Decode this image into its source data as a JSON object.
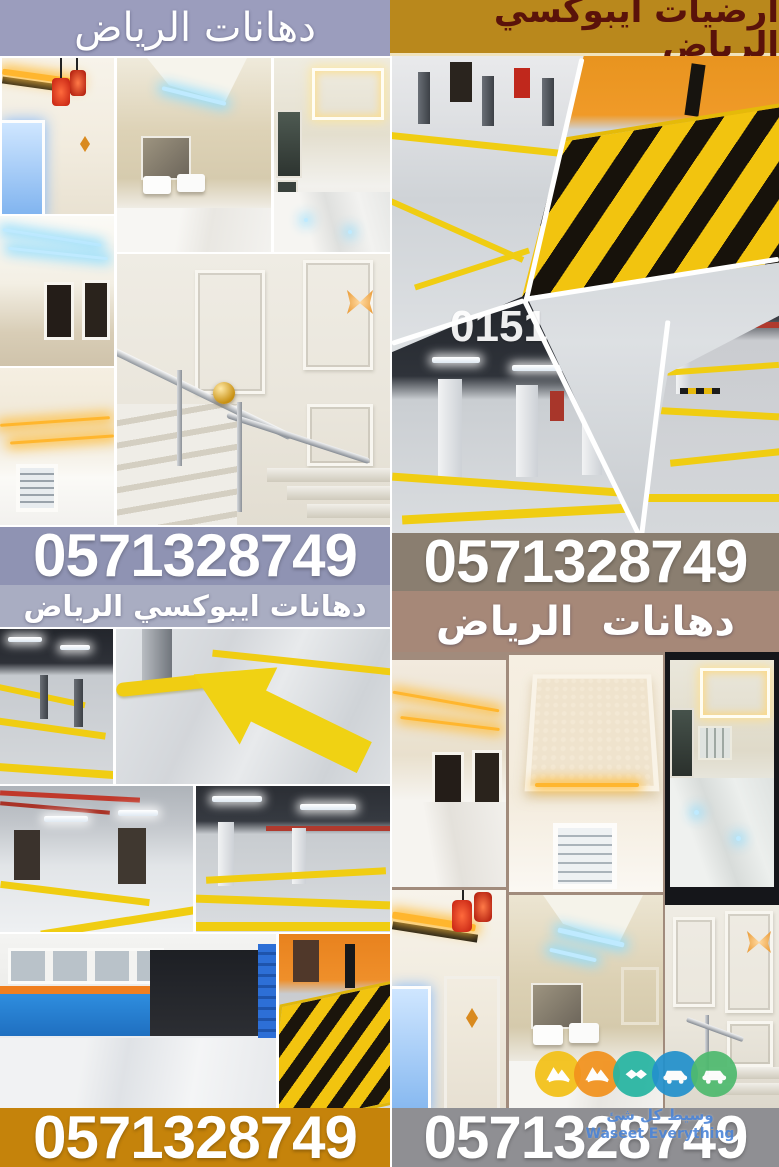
{
  "top_left": {
    "title": "دهانات الرياض"
  },
  "top_right": {
    "title": "ارضيات ايبوكسي الرياض"
  },
  "mid_left": {
    "phone": "0571328749",
    "caption": "دهانات ايبوكسي الرياض"
  },
  "mid_right": {
    "phone": "0571328749",
    "caption": "دهانات  الرياض"
  },
  "bottom_left": {
    "phone": "0571328749"
  },
  "bottom_right": {
    "phone": "0571328749"
  },
  "watermarks": {
    "partial_number": "0151",
    "logo_text_ar": "وسيط كل شئ",
    "logo_text_en": "Waseet Everything"
  },
  "logo": {
    "circles": [
      {
        "color": "#f3c117",
        "icon": "mountain-icon"
      },
      {
        "color": "#f2921d",
        "icon": "mountain-icon"
      },
      {
        "color": "#27b5a2",
        "icon": "handshake-icon"
      },
      {
        "color": "#2391cc",
        "icon": "car-icon"
      },
      {
        "color": "#4fba6f",
        "icon": "car-icon"
      }
    ]
  },
  "colors": {
    "left_title_bg": "#9b9dbd",
    "right_title_bg": "#b9881c",
    "right_title_text": "#5a120a",
    "left_phone_bg": "#8f93b3",
    "left_caption_bg": "#a9adc2",
    "right_phone_bg": "#8a7e70",
    "right_caption_bg": "#a68878",
    "bottom_left_band_bg": "#c5830b",
    "bottom_right_band_bg": "#8f8f93",
    "hazard_yellow": "#f2c40f",
    "epoxy_gray": "#d2d5d9"
  }
}
